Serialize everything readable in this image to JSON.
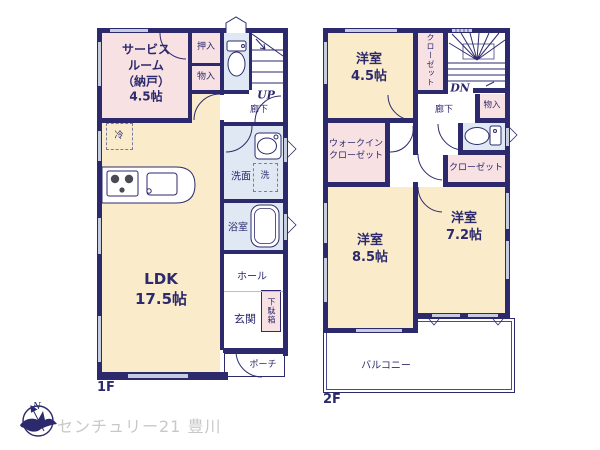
{
  "colors": {
    "wall_navy": "#2c2a6d",
    "room_pink": "#f8e1e3",
    "room_cream": "#faecca",
    "room_wet_blue": "#dfe8f3",
    "window_gray": "#c7cde0",
    "label_navy": "#2c2a6d",
    "brand_gray": "#c8c8c8"
  },
  "floor1": {
    "label": "1F",
    "rooms": {
      "service": "サービス\nルーム\n（納戸）\n4.5帖",
      "oshiire": "押入",
      "monoire": "物入",
      "up": "UP",
      "rouka": "廊下",
      "fridge": "冷",
      "ldk": "LDK\n17.5帖",
      "senmen": "洗面",
      "washer": "洗",
      "bath": "浴室",
      "hall": "ホール",
      "getabako": "下駄箱",
      "genkan": "玄関",
      "porch": "ポーチ"
    }
  },
  "floor2": {
    "label": "2F",
    "rooms": {
      "room45": "洋室\n4.5帖",
      "closet_upper": "クローゼット",
      "dn": "DN",
      "rouka": "廊下",
      "monoire": "物入",
      "wic": "ウォークイン\nクローゼット",
      "closet_lower": "クローゼット",
      "room85": "洋室\n8.5帖",
      "room72": "洋室\n7.2帖",
      "balcony": "バルコニー"
    }
  },
  "footer": {
    "brand": "センチュリー21 豊川",
    "compass_n": "N"
  }
}
